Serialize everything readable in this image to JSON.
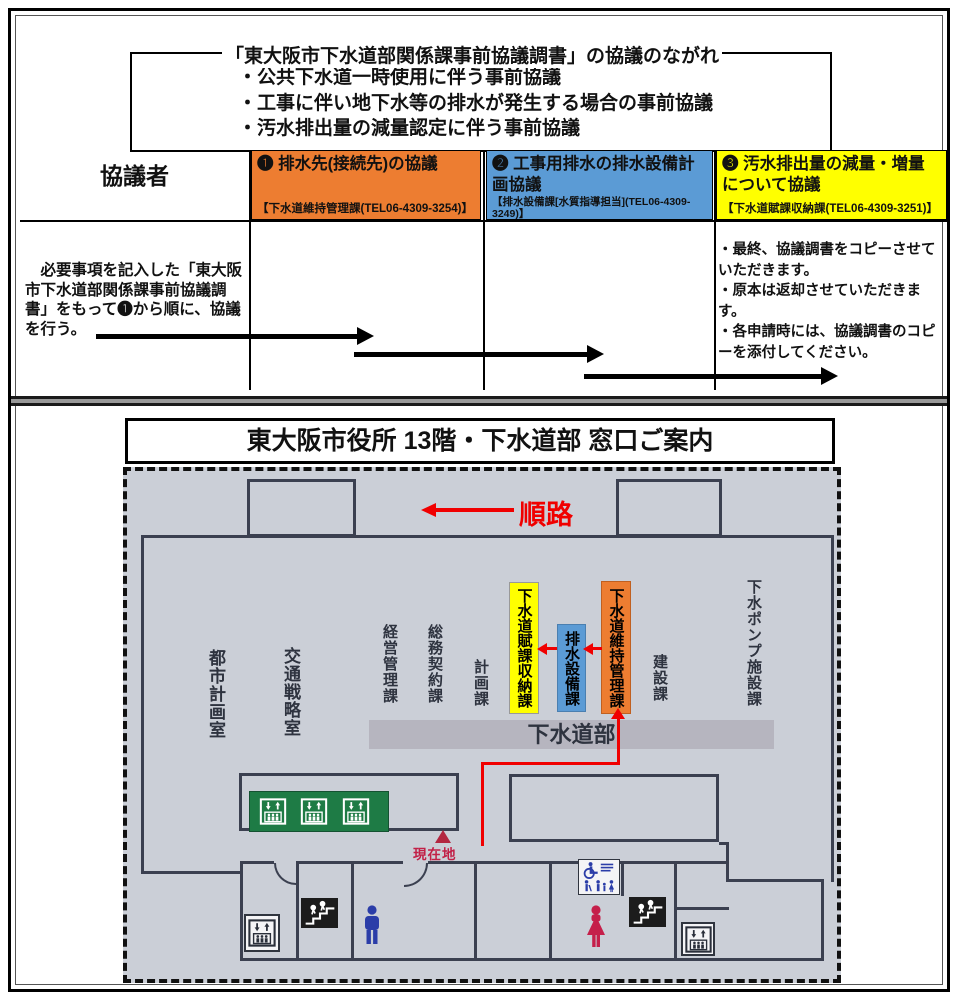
{
  "flow": {
    "title": "「東大阪市下水道部関係課事前協議調書」の協議のながれ",
    "bullets": [
      "・公共下水道一時使用に伴う事前協議",
      "・工事に伴い地下水等の排水が発生する場合の事前協議",
      "・汚水排出量の減量認定に伴う事前協議"
    ]
  },
  "table": {
    "party_header": "協議者",
    "columns": [
      {
        "title": "❶ 排水先(接続先)の協議",
        "contact": "【下水道維持管理課(TEL06-4309-3254)】",
        "color": "#ED7D31"
      },
      {
        "title": "❷ 工事用排水の排水設備計画協議",
        "contact": "【排水設備課[水質指導担当](TEL06-4309-3249)】",
        "color": "#5B9BD5"
      },
      {
        "title": "❸ 汚水排出量の減量・増量について協議",
        "contact": "【下水道賦課収納課(TEL06-4309-3251)】",
        "color": "#FFFF00"
      }
    ],
    "left_note": "　必要事項を記入した「東大阪市下水道部関係課事前協議調書」をもって❶から順に、協議を行う。",
    "right_notes": [
      "・最終、協議調書をコピーさせていただきます。",
      "・原本は返却させていただきます。",
      "・各申請時には、協議調書のコピーを添付してください。"
    ]
  },
  "map": {
    "title": "東大阪市役所 13階・下水道部 窓口ご案内",
    "route_label": "順路",
    "current_location_label": "現在地",
    "department_bar": "下水道部",
    "rooms": [
      {
        "label": "都市計画室"
      },
      {
        "label": "交通戦略室"
      },
      {
        "label": "経営管理課"
      },
      {
        "label": "総務契約課"
      },
      {
        "label": "計画課"
      },
      {
        "label": "下水道賦課収納課",
        "highlight_color": "#FFFF00"
      },
      {
        "label": "排水設備課",
        "highlight_color": "#5B9BD5"
      },
      {
        "label": "下水道維持管理課",
        "highlight_color": "#ED7D31"
      },
      {
        "label": "建設課"
      },
      {
        "label": "下水ポンプ施設課"
      }
    ],
    "icons": [
      "elevator-icon",
      "stairs-icon",
      "men-restroom-icon",
      "women-restroom-icon",
      "accessible-restroom-icon"
    ],
    "colors": {
      "map_background": "#CBCFD7",
      "wall": "#3B4050",
      "department_bar_gray": "#B6B5BF",
      "elevator_green": "#1E7B45",
      "route_red": "#F00000",
      "current_location_red": "#C22047",
      "men_icon_blue": "#2B3DA8",
      "women_icon_crimson": "#C51F4A"
    }
  }
}
